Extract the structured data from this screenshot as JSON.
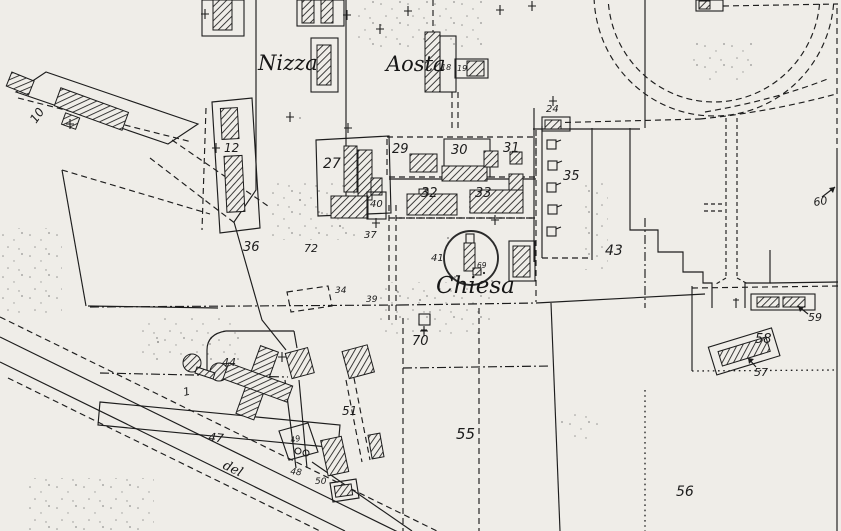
{
  "document": {
    "kind": "scanned cadastral town map",
    "colors": {
      "paper": "#efede8",
      "ink": "#1d1d1d"
    }
  },
  "streets": {
    "nizza": "Nizza",
    "aosta": "Aosta",
    "chiesa": "Chiesa",
    "del": "del"
  },
  "labels": {
    "p1": "1",
    "p10": "10",
    "p12": "12",
    "p18": "18",
    "p19": "19",
    "p24": "24",
    "p27": "27",
    "p29": "29",
    "p30": "30",
    "p31": "31",
    "p32": "32",
    "p33": "33",
    "p34": "34",
    "p35": "35",
    "p36": "36",
    "p37": "37",
    "p39": "39",
    "p40": "40",
    "p41": "41",
    "p43": "43",
    "p44": "44",
    "p47": "47",
    "p48": "48",
    "p49": "49",
    "p50": "50",
    "p51": "51",
    "p55": "55",
    "p56": "56",
    "p57": "57",
    "p58": "58",
    "p59": "59",
    "p60": "60",
    "p69": "69",
    "p70": "70",
    "p72": "72"
  }
}
